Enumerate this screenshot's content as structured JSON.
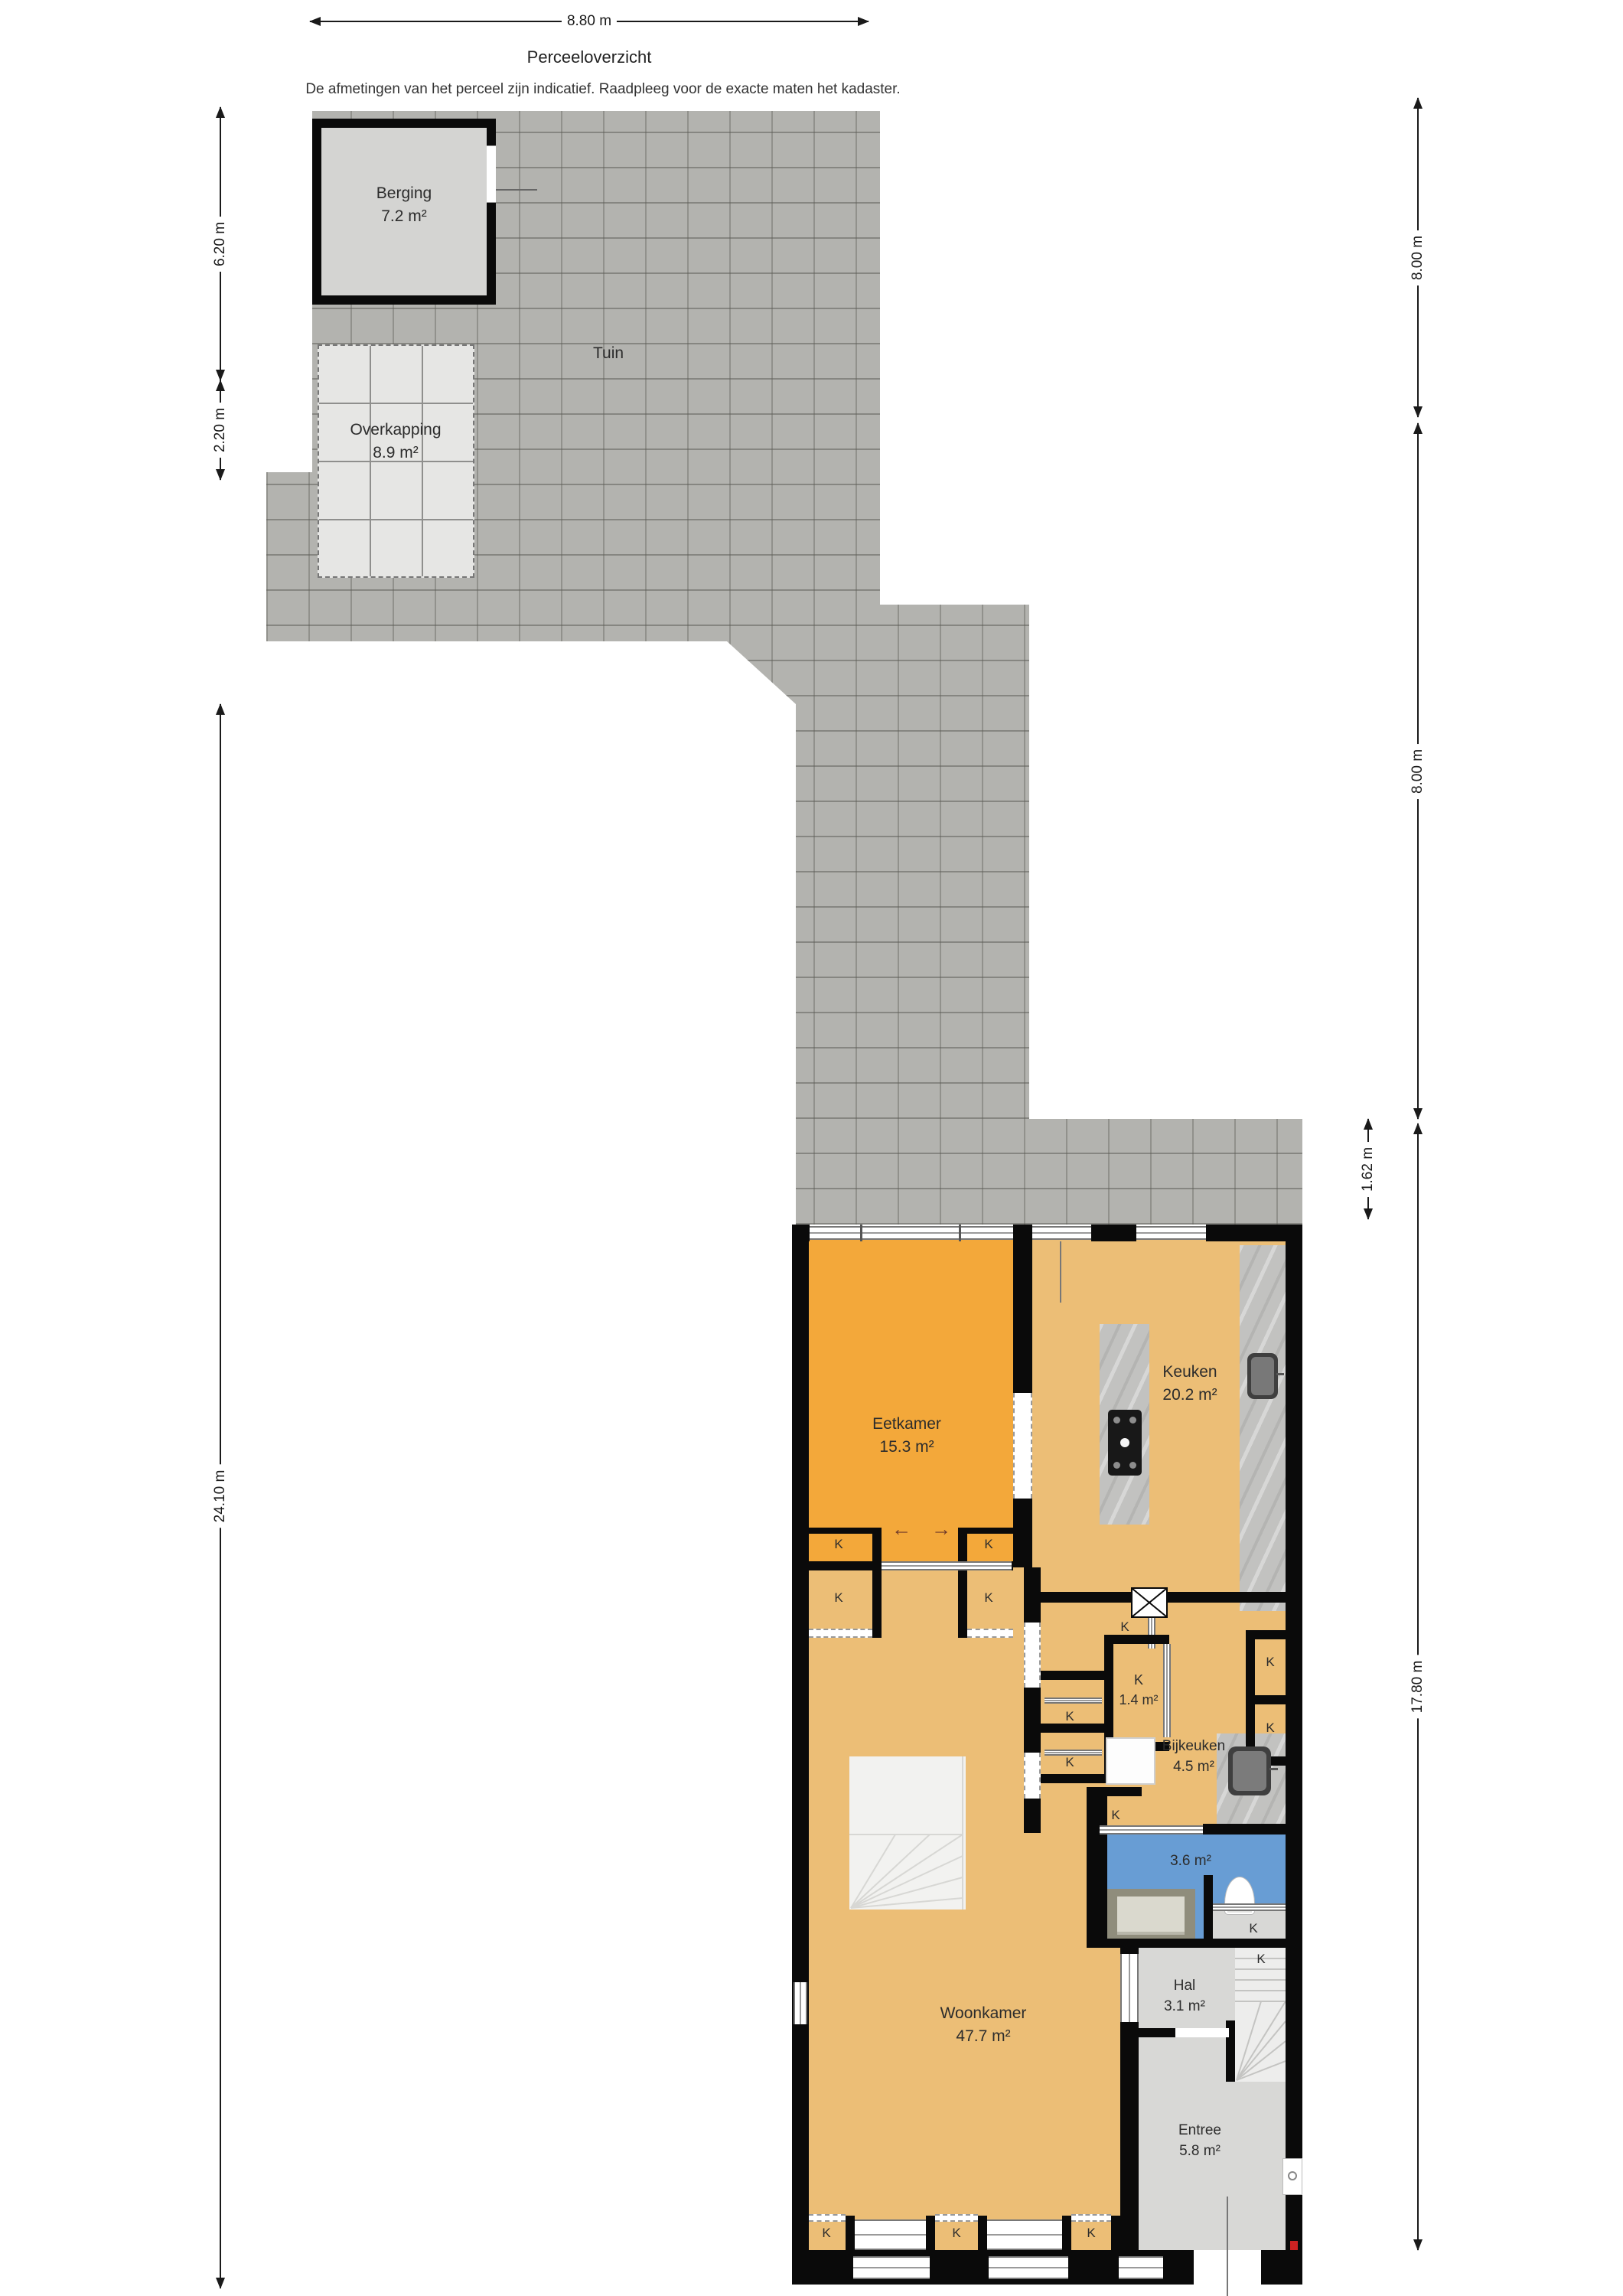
{
  "title": "Perceeloverzicht",
  "disclaimer": "De afmetingen van het perceel zijn indicatief. Raadpleeg voor de exacte maten het kadaster.",
  "dimensions": {
    "top_width": "8.80 m",
    "left_upper": "6.20 m",
    "left_lower": "2.20 m",
    "left_total": "24.10 m",
    "right_upper": "8.00 m",
    "right_middle": "8.00 m",
    "right_strip": "1.62 m",
    "right_house": "17.80 m"
  },
  "outdoor": {
    "tuin_label": "Tuin",
    "berging": {
      "name": "Berging",
      "area": "7.2 m²"
    },
    "overkapping": {
      "name": "Overkapping",
      "area": "8.9 m²"
    }
  },
  "rooms": {
    "eetkamer": {
      "name": "Eetkamer",
      "area": "15.3 m²"
    },
    "keuken": {
      "name": "Keuken",
      "area": "20.2 m²"
    },
    "kast": {
      "name": "K",
      "area": "1.4 m²"
    },
    "bijkeuken": {
      "name": "Bijkeuken",
      "area": "4.5 m²"
    },
    "badkamer": {
      "area": "3.6 m²"
    },
    "woonkamer": {
      "name": "Woonkamer",
      "area": "47.7 m²"
    },
    "hal": {
      "name": "Hal",
      "area": "3.1 m²"
    },
    "entree": {
      "name": "Entree",
      "area": "5.8 m²"
    }
  },
  "closet_label": "K",
  "door_arrows": {
    "left": "←",
    "right": "→"
  },
  "colors": {
    "wall": "#0a0a0a",
    "paving": "#b3b3af",
    "eetkamer_fill": "#f3a83a",
    "floor_fill": "#ecbe76",
    "bathroom_fill": "#689dd4",
    "gray_room_fill": "#d8d8d6",
    "stairs_fill": "#ededec",
    "counter_fill": "#c2c2c0",
    "berging_fill": "#d4d4d2",
    "overkapping_fill": "#e6e6e4",
    "vanity_fill": "#8f8d7c",
    "arrow_color": "#6e3a2a",
    "dim_color": "#1a1a1a"
  }
}
